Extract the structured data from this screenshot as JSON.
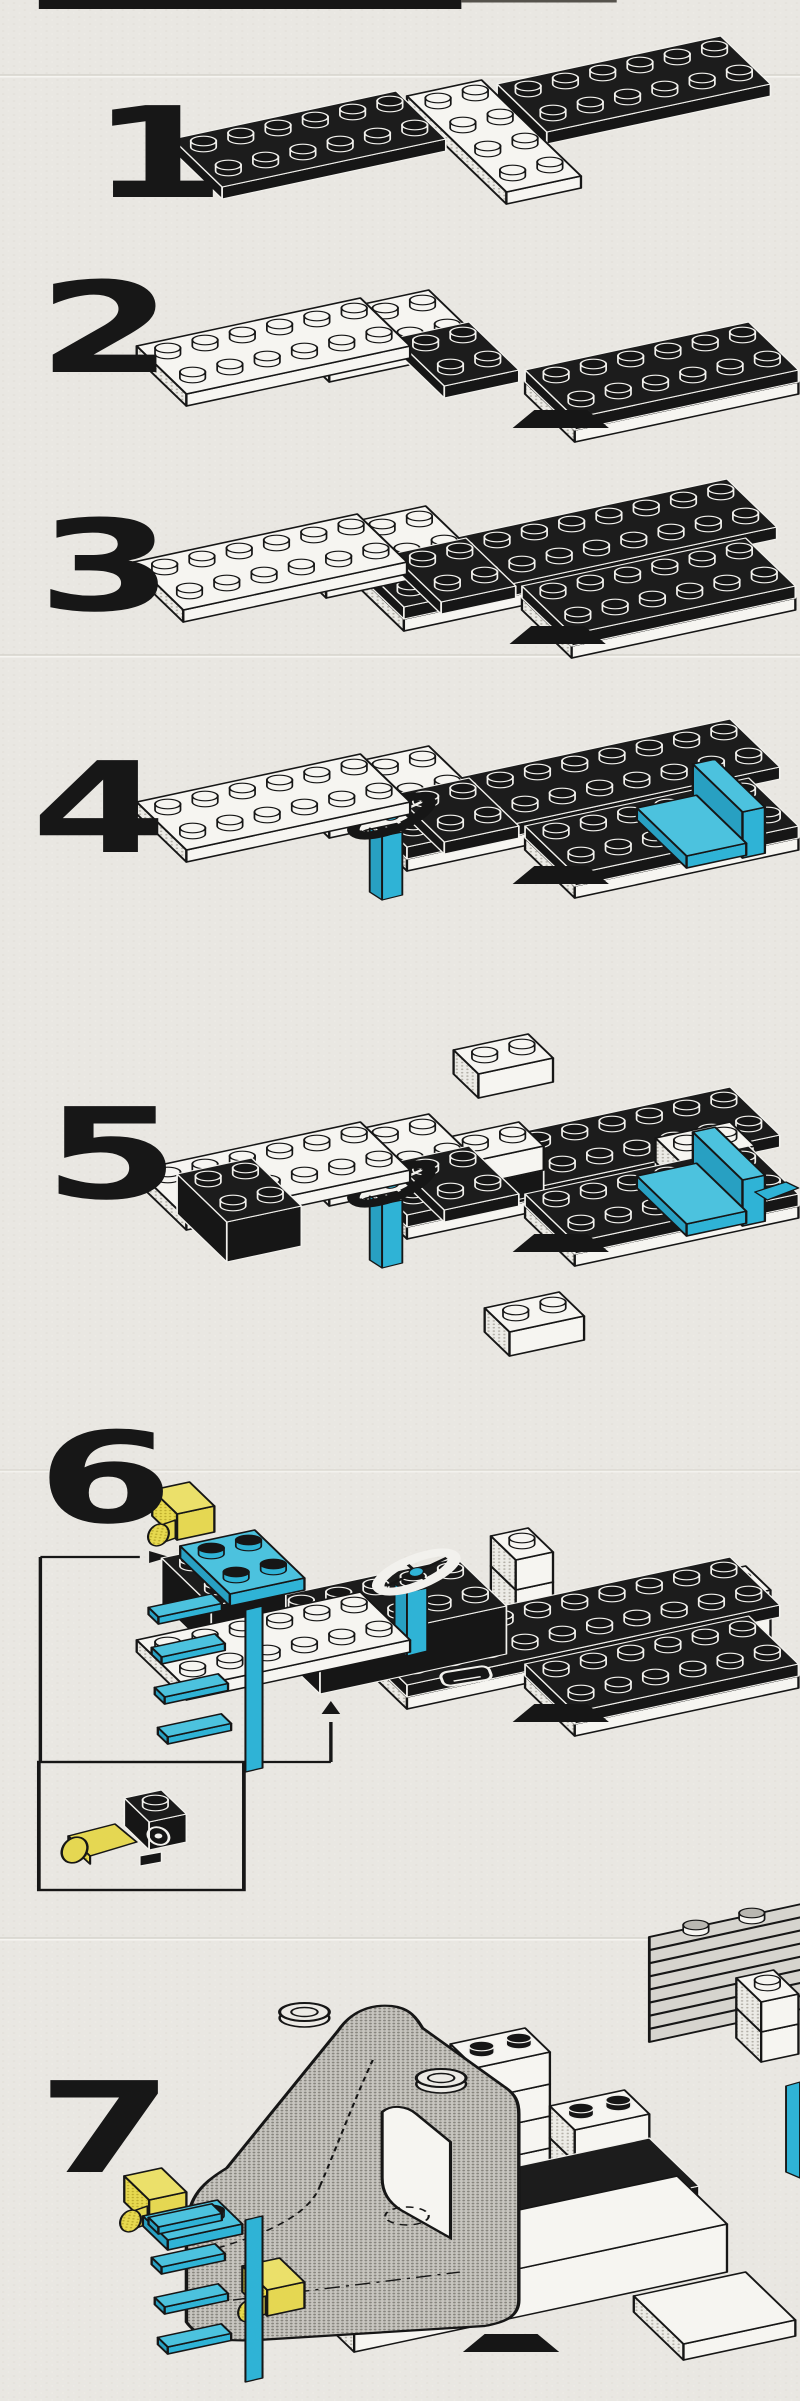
{
  "page": {
    "type": "lego-building-instruction-sheet",
    "background": "#e9e7e2",
    "header_bar_color": "#161616",
    "step_count": "7"
  },
  "palette": {
    "paper": "#e9e7e2",
    "black": "#161616",
    "white_part": "#f6f5f1",
    "cyan": "#2fb3d6",
    "yellow": "#e5d752",
    "line": "#161616",
    "halftone": "#b3b0a8"
  },
  "steps": [
    {
      "label": "1",
      "parts": [
        {
          "s": "box",
          "x": 352,
          "y": 144,
          "w": 6,
          "d": 2,
          "h": 12,
          "c": "k"
        },
        {
          "s": "box",
          "x": 326,
          "y": 204,
          "w": 2,
          "d": 4,
          "h": 12,
          "c": "w"
        },
        {
          "s": "box",
          "x": 143,
          "y": 199,
          "w": 6,
          "d": 2,
          "h": 12,
          "c": "k"
        }
      ]
    },
    {
      "label": "2",
      "parts": [
        {
          "s": "box",
          "x": 212,
          "y": 382,
          "w": 4,
          "d": 2,
          "h": 12,
          "c": "w"
        },
        {
          "s": "box",
          "x": 286,
          "y": 398,
          "w": 2,
          "d": 2,
          "h": 12,
          "c": "k"
        },
        {
          "s": "box",
          "x": 370,
          "y": 442,
          "w": 6,
          "d": 2,
          "h": 12,
          "c": "w"
        },
        {
          "s": "box",
          "x": 370,
          "y": 430,
          "w": 6,
          "d": 2,
          "h": 12,
          "c": "k"
        },
        {
          "s": "box",
          "x": 120,
          "y": 406,
          "w": 6,
          "d": 2,
          "h": 12,
          "c": "w"
        },
        {
          "s": "arch",
          "x": 330,
          "y": 428
        }
      ]
    },
    {
      "label": "3",
      "parts": [
        {
          "s": "box",
          "x": 260,
          "y": 631,
          "w": 4,
          "d": 2,
          "h": 12,
          "c": "w"
        },
        {
          "s": "box",
          "x": 260,
          "y": 619,
          "w": 10,
          "d": 2,
          "h": 12,
          "c": "k"
        },
        {
          "s": "box",
          "x": 210,
          "y": 598,
          "w": 4,
          "d": 2,
          "h": 12,
          "c": "w"
        },
        {
          "s": "box",
          "x": 284,
          "y": 614,
          "w": 2,
          "d": 2,
          "h": 12,
          "c": "k"
        },
        {
          "s": "box",
          "x": 368,
          "y": 658,
          "w": 6,
          "d": 2,
          "h": 12,
          "c": "w"
        },
        {
          "s": "box",
          "x": 368,
          "y": 646,
          "w": 6,
          "d": 2,
          "h": 12,
          "c": "k"
        },
        {
          "s": "box",
          "x": 118,
          "y": 622,
          "w": 6,
          "d": 2,
          "h": 12,
          "c": "w"
        },
        {
          "s": "arch",
          "x": 328,
          "y": 644
        }
      ]
    },
    {
      "label": "4",
      "parts": [
        {
          "s": "box",
          "x": 262,
          "y": 871,
          "w": 4,
          "d": 2,
          "h": 12,
          "c": "w"
        },
        {
          "s": "box",
          "x": 262,
          "y": 859,
          "w": 10,
          "d": 2,
          "h": 12,
          "c": "k"
        },
        {
          "s": "box",
          "x": 212,
          "y": 838,
          "w": 4,
          "d": 2,
          "h": 12,
          "c": "w"
        },
        {
          "s": "box",
          "x": 286,
          "y": 854,
          "w": 2,
          "d": 2,
          "h": 12,
          "c": "k"
        },
        {
          "s": "box",
          "x": 370,
          "y": 898,
          "w": 6,
          "d": 2,
          "h": 12,
          "c": "w"
        },
        {
          "s": "box",
          "x": 370,
          "y": 886,
          "w": 6,
          "d": 2,
          "h": 12,
          "c": "k"
        },
        {
          "s": "seat",
          "x": 442,
          "y": 868
        },
        {
          "s": "steer",
          "x": 252,
          "y": 816
        },
        {
          "s": "box",
          "x": 120,
          "y": 862,
          "w": 6,
          "d": 2,
          "h": 12,
          "c": "w"
        },
        {
          "s": "arch",
          "x": 330,
          "y": 884
        }
      ]
    },
    {
      "label": "5",
      "parts": [
        {
          "s": "box",
          "x": 262,
          "y": 1239,
          "w": 4,
          "d": 2,
          "h": 12,
          "c": "w"
        },
        {
          "s": "box",
          "x": 262,
          "y": 1227,
          "w": 10,
          "d": 2,
          "h": 12,
          "c": "k"
        },
        {
          "s": "box",
          "x": 438,
          "y": 1210,
          "w": 2,
          "d": 1,
          "h": 24,
          "c": "k"
        },
        {
          "s": "box",
          "x": 438,
          "y": 1186,
          "w": 2,
          "d": 1,
          "h": 24,
          "c": "w"
        },
        {
          "s": "box",
          "x": 302,
          "y": 1210,
          "w": 2,
          "d": 1,
          "h": 24,
          "c": "k"
        },
        {
          "s": "box",
          "x": 302,
          "y": 1186,
          "w": 2,
          "d": 1,
          "h": 24,
          "c": "w"
        },
        {
          "s": "box",
          "x": 308,
          "y": 1098,
          "w": 2,
          "d": 1,
          "h": 24,
          "c": "w"
        },
        {
          "s": "box",
          "x": 212,
          "y": 1206,
          "w": 4,
          "d": 2,
          "h": 12,
          "c": "w"
        },
        {
          "s": "box",
          "x": 286,
          "y": 1222,
          "w": 2,
          "d": 2,
          "h": 12,
          "c": "k"
        },
        {
          "s": "box",
          "x": 370,
          "y": 1266,
          "w": 6,
          "d": 2,
          "h": 12,
          "c": "w"
        },
        {
          "s": "box",
          "x": 370,
          "y": 1254,
          "w": 6,
          "d": 2,
          "h": 12,
          "c": "k"
        },
        {
          "s": "seat",
          "x": 442,
          "y": 1236
        },
        {
          "s": "steer",
          "x": 252,
          "y": 1184
        },
        {
          "s": "box",
          "x": 120,
          "y": 1230,
          "w": 6,
          "d": 2,
          "h": 12,
          "c": "w"
        },
        {
          "s": "box",
          "x": 146,
          "y": 1262,
          "w": 2,
          "d": 2,
          "h": 40,
          "c": "k"
        },
        {
          "s": "arch",
          "x": 330,
          "y": 1252
        },
        {
          "s": "flag",
          "x": 486,
          "y": 1192
        }
      ]
    },
    {
      "label": "6",
      "parts": [
        {
          "s": "box",
          "x": 332,
          "y": 1650,
          "w": 1,
          "d": 1,
          "h": 30,
          "c": "w"
        },
        {
          "s": "box",
          "x": 332,
          "y": 1620,
          "w": 1,
          "d": 1,
          "h": 30,
          "c": "w"
        },
        {
          "s": "box",
          "x": 332,
          "y": 1590,
          "w": 1,
          "d": 1,
          "h": 30,
          "c": "w"
        },
        {
          "s": "box",
          "x": 328,
          "y": 1356,
          "w": 2,
          "d": 1,
          "h": 24,
          "c": "w"
        },
        {
          "s": "box",
          "x": 400,
          "y": 1674,
          "w": 4,
          "d": 1,
          "h": 26,
          "c": "w"
        },
        {
          "s": "box",
          "x": 400,
          "y": 1648,
          "w": 4,
          "d": 1,
          "h": 26,
          "c": "w",
          "st": "k"
        },
        {
          "s": "box",
          "x": 262,
          "y": 1709,
          "w": 4,
          "d": 2,
          "h": 12,
          "c": "w"
        },
        {
          "s": "box",
          "x": 262,
          "y": 1697,
          "w": 10,
          "d": 2,
          "h": 12,
          "c": "k"
        },
        {
          "s": "box",
          "x": 206,
          "y": 1694,
          "w": 5,
          "d": 2,
          "h": 48,
          "c": "k"
        },
        {
          "s": "box",
          "x": 370,
          "y": 1736,
          "w": 6,
          "d": 2,
          "h": 12,
          "c": "w"
        },
        {
          "s": "box",
          "x": 370,
          "y": 1724,
          "w": 6,
          "d": 2,
          "h": 12,
          "c": "k"
        },
        {
          "s": "steer",
          "x": 268,
          "y": 1572,
          "v": "w"
        },
        {
          "s": "box",
          "x": 136,
          "y": 1652,
          "w": 2,
          "d": 2,
          "h": 46,
          "c": "k"
        },
        {
          "s": "box",
          "x": 148,
          "y": 1606,
          "w": 2,
          "d": 2,
          "h": 12,
          "c": "c"
        },
        {
          "s": "ylight",
          "x": 114,
          "y": 1540
        },
        {
          "s": "ylight",
          "x": 196,
          "y": 1668
        },
        {
          "s": "box",
          "x": 120,
          "y": 1700,
          "w": 6,
          "d": 2,
          "h": 12,
          "c": "w"
        },
        {
          "s": "ladder",
          "x": 158,
          "y": 1772
        },
        {
          "s": "arch",
          "x": 330,
          "y": 1722
        },
        {
          "s": "hitch",
          "x": 300,
          "y": 1676
        },
        {
          "s": "iy",
          "x": 44,
          "y": 1836
        },
        {
          "s": "ib",
          "x": 96,
          "y": 1850
        }
      ],
      "annotations": {
        "lines": [
          [
            26,
            1557,
            90,
            1557
          ],
          [
            26,
            1557,
            26,
            1762
          ],
          [
            157,
            1762,
            213,
            1762
          ],
          [
            213,
            1762,
            213,
            1722
          ]
        ],
        "arrows": [
          {
            "x": 96,
            "y": 1557,
            "d": "r"
          },
          {
            "x": 213,
            "y": 1714,
            "d": "u"
          }
        ],
        "boxes": [
          [
            25,
            1762,
            132,
            128
          ]
        ]
      }
    },
    {
      "label": "7",
      "parts": [
        {
          "s": "louver",
          "x": 418,
          "y": 2042
        },
        {
          "s": "box",
          "x": 490,
          "y": 2062,
          "w": 1,
          "d": 1,
          "h": 30,
          "c": "w"
        },
        {
          "s": "box",
          "x": 490,
          "y": 2032,
          "w": 1,
          "d": 1,
          "h": 30,
          "c": "w"
        },
        {
          "s": "edgecyan",
          "x": 506,
          "y": 2086
        },
        {
          "s": "box",
          "x": 306,
          "y": 2196,
          "w": 2,
          "d": 1,
          "h": 32,
          "c": "w"
        },
        {
          "s": "box",
          "x": 306,
          "y": 2164,
          "w": 2,
          "d": 1,
          "h": 32,
          "c": "w"
        },
        {
          "s": "box",
          "x": 306,
          "y": 2132,
          "w": 2,
          "d": 1,
          "h": 32,
          "c": "w"
        },
        {
          "s": "box",
          "x": 306,
          "y": 2100,
          "w": 2,
          "d": 1,
          "h": 32,
          "c": "w",
          "st": "k"
        },
        {
          "s": "box",
          "x": 370,
          "y": 2226,
          "w": 2,
          "d": 1,
          "h": 32,
          "c": "w"
        },
        {
          "s": "box",
          "x": 370,
          "y": 2194,
          "w": 2,
          "d": 1,
          "h": 32,
          "c": "w"
        },
        {
          "s": "box",
          "x": 370,
          "y": 2162,
          "w": 2,
          "d": 1,
          "h": 32,
          "c": "w",
          "st": "k"
        },
        {
          "s": "box",
          "x": 234,
          "y": 2304,
          "w": 9,
          "d": 2,
          "h": 46,
          "c": "k",
          "st": false
        },
        {
          "s": "hitch",
          "x": 352,
          "y": 2266
        },
        {
          "s": "box",
          "x": 440,
          "y": 2360,
          "w": 3,
          "d": 2,
          "h": 16,
          "c": "w",
          "st": false
        },
        {
          "s": "box",
          "x": 228,
          "y": 2352,
          "w": 10,
          "d": 2,
          "h": 48,
          "c": "w",
          "st": false
        },
        {
          "s": "arch",
          "x": 298,
          "y": 2352
        },
        {
          "s": "cab",
          "x": 0,
          "y": 0
        },
        {
          "s": "ylight",
          "x": 96,
          "y": 2226
        },
        {
          "s": "box",
          "x": 108,
          "y": 2250,
          "w": 2,
          "d": 1,
          "h": 10,
          "c": "c"
        },
        {
          "s": "ylight",
          "x": 172,
          "y": 2316
        },
        {
          "s": "ladder",
          "x": 158,
          "y": 2382
        }
      ]
    }
  ]
}
